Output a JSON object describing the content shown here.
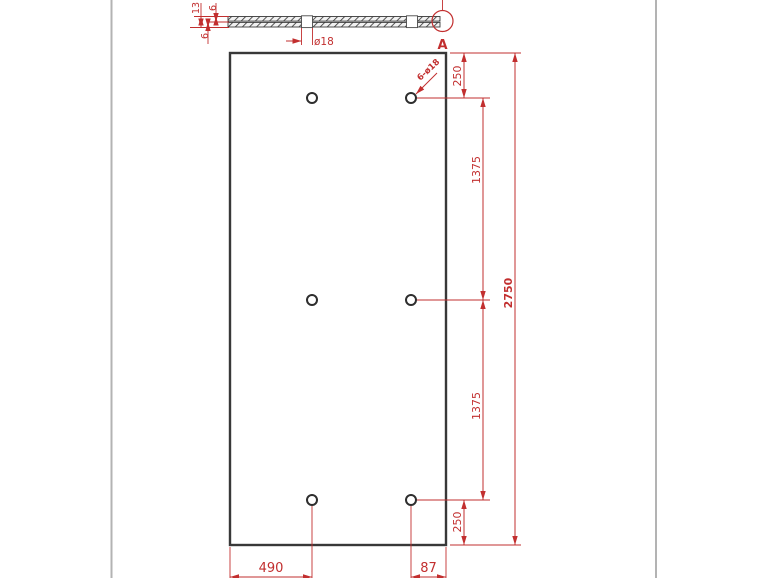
{
  "colors": {
    "dimension": "#c22f2f",
    "outline": "#383838",
    "page_border": "#b3b3b3"
  },
  "section_view": {
    "total_thickness": "13",
    "top_layer": "6",
    "bottom_layer": "6",
    "hole_diameter": "ø18",
    "detail_label": "A"
  },
  "front_view": {
    "hole_callout": "6-ø18",
    "edge_to_hole_top": "250",
    "hole_spacing_upper": "1375",
    "overall_height": "2750",
    "hole_spacing_lower": "1375",
    "edge_to_hole_bottom": "250",
    "edge_to_hole_left": "490",
    "hole_to_edge_right": "87"
  }
}
